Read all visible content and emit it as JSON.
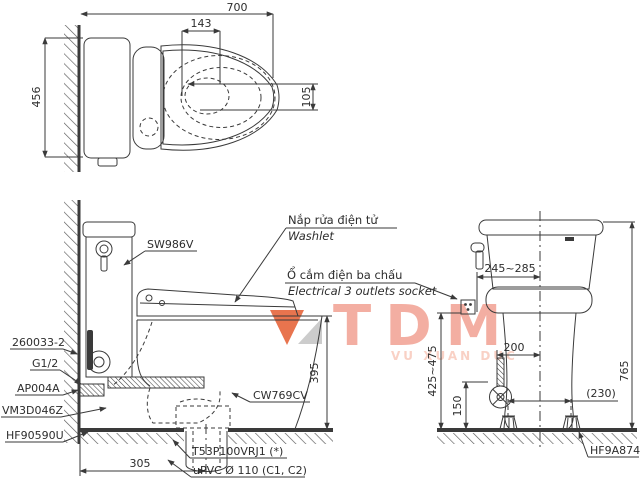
{
  "watermark": {
    "brand": "TDM",
    "owner": "VU XUAN DUC"
  },
  "callouts": {
    "washlet_vi": "Nắp rửa điện tử",
    "washlet_en": "Washlet",
    "socket_vi": "Ổ cắm điện ba chấu",
    "socket_en": "Electrical 3 outlets socket"
  },
  "parts": {
    "seat": "SW986V",
    "fill_valve": "260033-2",
    "thread": "G1/2",
    "stop_valve": "AP004A",
    "outlet_flange": "VM3D046Z",
    "gasket": "HF90590U",
    "bowl": "CW769CV",
    "drain_joint": "T53P100VRJ1 (*)",
    "drain_pipe": "uPVC Ø 110 (C1, C2)",
    "bolt_cap": "HF9A874"
  },
  "dims": {
    "depth": "700",
    "seat_width": "143",
    "jet_offset": "105",
    "width": "456",
    "rim_height": "395",
    "outlet_setback": "305",
    "supply_range": "245~285",
    "height": "765",
    "supply_offset": "200",
    "bolt_spacing": "(230)",
    "valve_height": "150",
    "socket_height": "425~475"
  },
  "colors": {
    "line": "#3a3a3a",
    "watermark": "#f2a192",
    "watermark_light": "#f8c9bc",
    "logo_orange": "#e55c30",
    "logo_gray": "#c4c4c4"
  }
}
